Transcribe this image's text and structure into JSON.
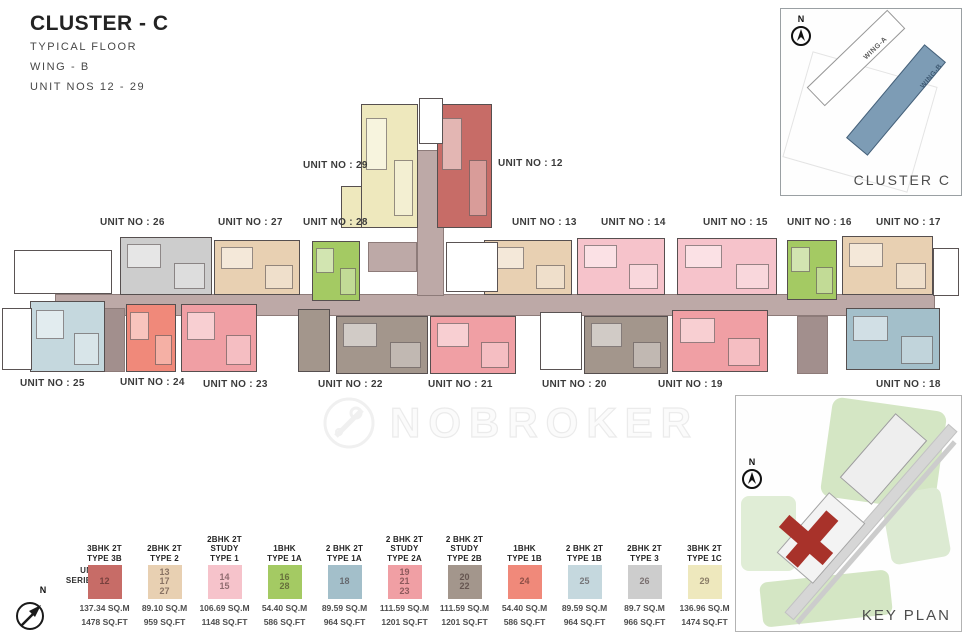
{
  "title": {
    "main": "CLUSTER - C",
    "lines": [
      "TYPICAL FLOOR",
      "WING - B",
      "UNIT NOS 12 - 29"
    ]
  },
  "cluster_inset": {
    "north": "N",
    "wing_a": "WING-A",
    "wing_b": "WING-B",
    "caption": "CLUSTER C"
  },
  "key_plan": {
    "north": "N",
    "caption": "KEY PLAN"
  },
  "watermark": {
    "text": "NOBROKER"
  },
  "compass": {
    "north": "N"
  },
  "plan": {
    "labels": {
      "u12": "UNIT NO : 12",
      "u13": "UNIT NO : 13",
      "u14": "UNIT NO : 14",
      "u15": "UNIT NO : 15",
      "u16": "UNIT NO : 16",
      "u17": "UNIT NO : 17",
      "u18": "UNIT NO : 18",
      "u19": "UNIT NO : 19",
      "u20": "UNIT NO : 20",
      "u21": "UNIT NO : 21",
      "u22": "UNIT NO : 22",
      "u23": "UNIT NO : 23",
      "u24": "UNIT NO : 24",
      "u25": "UNIT NO : 25",
      "u26": "UNIT NO : 26",
      "u27": "UNIT NO : 27",
      "u28": "UNIT NO : 28",
      "u29": "UNIT NO : 29"
    }
  },
  "legend": {
    "series_label": "UNIT\nSERIES:",
    "entries": [
      {
        "title": "3BHK 2T\nTYPE 3B",
        "units": "12",
        "sqm": "137.34 SQ.M",
        "sqft": "1478 SQ.FT",
        "color": "#c76c67"
      },
      {
        "title": "2BHK 2T\nTYPE 2",
        "units": "13\n17\n27",
        "sqm": "89.10 SQ.M",
        "sqft": "959 SQ.FT",
        "color": "#e8d0b2"
      },
      {
        "title": "2BHK 2T\nSTUDY\nTYPE 1",
        "units": "14\n15",
        "sqm": "106.69 SQ.M",
        "sqft": "1148 SQ.FT",
        "color": "#f6c3cb"
      },
      {
        "title": "1BHK\nTYPE 1A",
        "units": "16\n28",
        "sqm": "54.40 SQ.M",
        "sqft": "586 SQ.FT",
        "color": "#a4ca63"
      },
      {
        "title": "2 BHK 2T\nTYPE 1A",
        "units": "18",
        "sqm": "89.59 SQ.M",
        "sqft": "964 SQ.FT",
        "color": "#a3bfca"
      },
      {
        "title": "2 BHK 2T\nSTUDY\nTYPE 2A",
        "units": "19\n21\n23",
        "sqm": "111.59 SQ.M",
        "sqft": "1201 SQ.FT",
        "color": "#f09fa4"
      },
      {
        "title": "2 BHK 2T\nSTUDY\nTYPE 2B",
        "units": "20\n22",
        "sqm": "111.59 SQ.M",
        "sqft": "1201 SQ.FT",
        "color": "#a3968c"
      },
      {
        "title": "1BHK\nTYPE 1B",
        "units": "24",
        "sqm": "54.40 SQ.M",
        "sqft": "586 SQ.FT",
        "color": "#f0897a"
      },
      {
        "title": "2 BHK 2T\nTYPE 1B",
        "units": "25",
        "sqm": "89.59 SQ.M",
        "sqft": "964 SQ.FT",
        "color": "#c5d8de"
      },
      {
        "title": "2BHK 2T\nTYPE 3",
        "units": "26",
        "sqm": "89.7 SQ.M",
        "sqft": "966 SQ.FT",
        "color": "#cdcdcd"
      },
      {
        "title": "3BHK 2T\nTYPE 1C",
        "units": "29",
        "sqm": "136.96 SQ.M",
        "sqft": "1474 SQ.FT",
        "color": "#eee8bd"
      }
    ]
  },
  "colors": {
    "type3b": "#c76c67",
    "type2": "#e8d0b2",
    "study1": "#f6c3cb",
    "green1a": "#a4ca63",
    "blue1a": "#a3bfca",
    "study2a": "#f09fa4",
    "study2b": "#a3968c",
    "coral1b": "#f0897a",
    "blue1b": "#c5d8de",
    "type3": "#cdcdcd",
    "type1c": "#eee8bd",
    "corridor": "#bda9a7",
    "corridordark": "#a28f8d",
    "wingb": "#7d9cb5",
    "kpgreen": "#d4e6c4",
    "kpred": "#a8322a"
  }
}
